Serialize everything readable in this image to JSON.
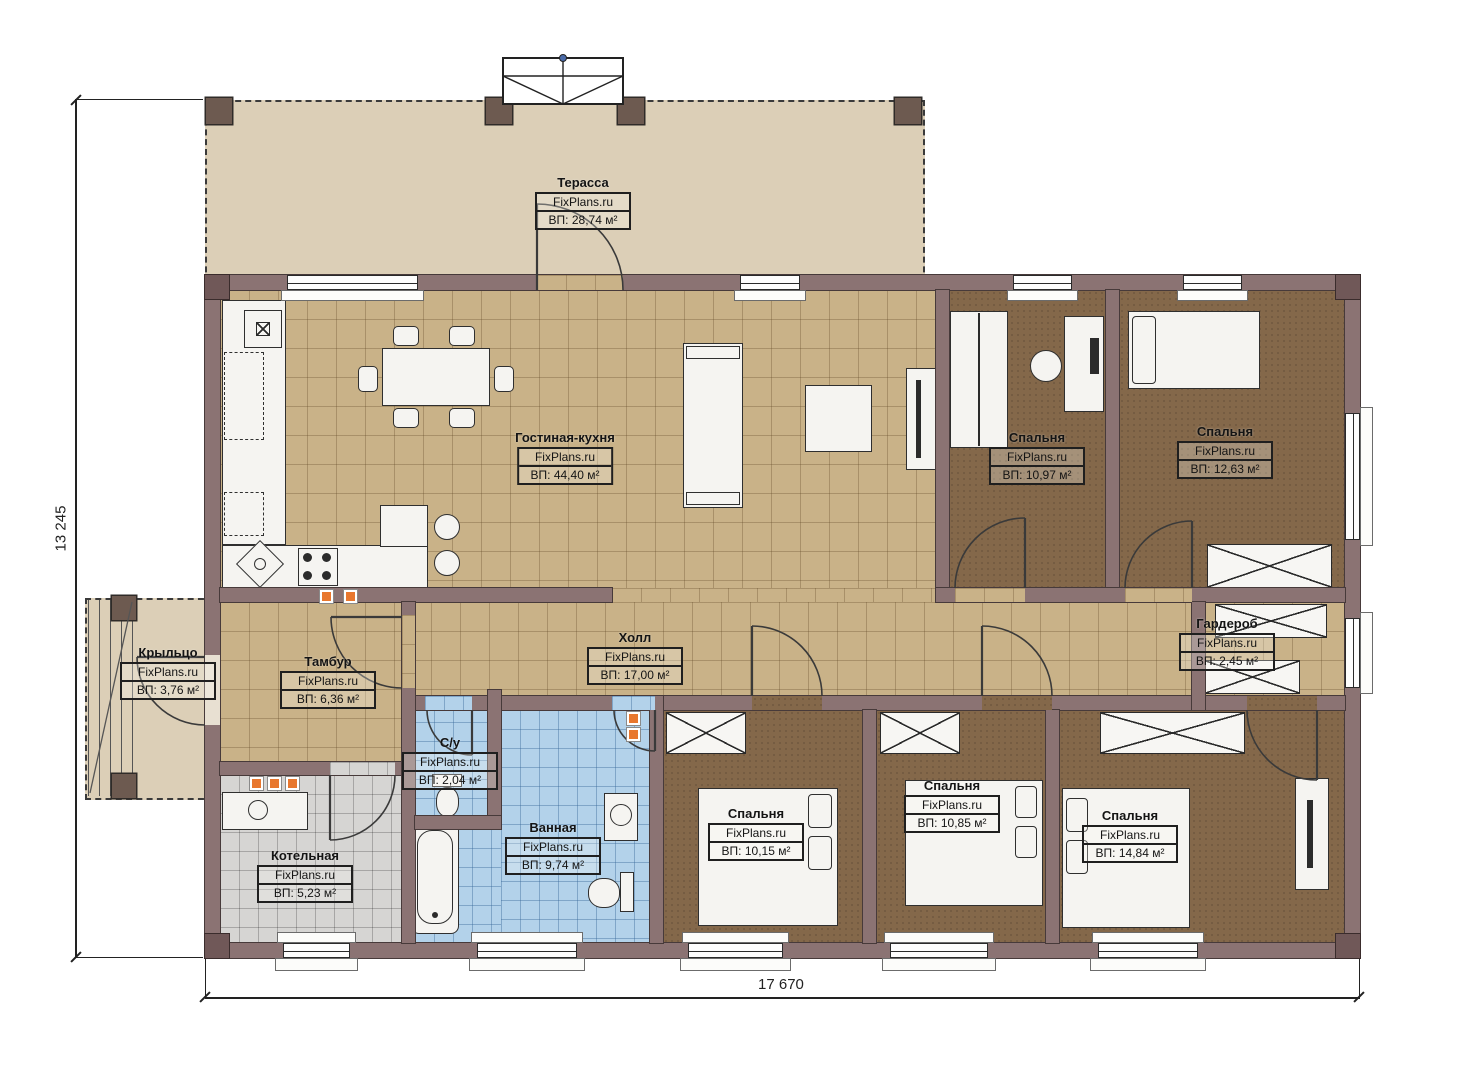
{
  "plan": {
    "brand": "FixPlans.ru",
    "dimensions": {
      "height_label": "13 245",
      "width_label": "17 670"
    },
    "rooms": {
      "terrace": {
        "name": "Терасса",
        "area": "ВП: 28,74 м²"
      },
      "living": {
        "name": "Гостиная-кухня",
        "area": "ВП: 44,40 м²"
      },
      "bedroom1": {
        "name": "Спальня",
        "area": "ВП: 10,97 м²"
      },
      "bedroom2": {
        "name": "Спальня",
        "area": "ВП: 12,63 м²"
      },
      "porch": {
        "name": "Крыльцо",
        "area": "ВП: 3,76 м²"
      },
      "tambour": {
        "name": "Тамбур",
        "area": "ВП: 6,36 м²"
      },
      "hall": {
        "name": "Холл",
        "area": "ВП: 17,00 м²"
      },
      "wardrobe": {
        "name": "Гардероб",
        "area": "ВП: 2,45 м²"
      },
      "wc": {
        "name": "С/у",
        "area": "ВП: 2,04 м²"
      },
      "bathroom": {
        "name": "Ванная",
        "area": "ВП: 9,74 м²"
      },
      "boiler": {
        "name": "Котельная",
        "area": "ВП: 5,23 м²"
      },
      "bedroom3": {
        "name": "Спальня",
        "area": "ВП: 10,15 м²"
      },
      "bedroom4": {
        "name": "Спальня",
        "area": "ВП: 10,85 м²"
      },
      "bedroom5": {
        "name": "Спальня",
        "area": "ВП: 14,84 м²"
      }
    },
    "colors": {
      "wall": "#8b7373",
      "terrace_floor": "#dccfb7",
      "tile_floor": "#c9b288",
      "carpet_floor": "#84684a",
      "bath_tile": "#b3d2ea",
      "boiler_tile": "#d6d5d3",
      "accent": "#e8772e"
    }
  }
}
